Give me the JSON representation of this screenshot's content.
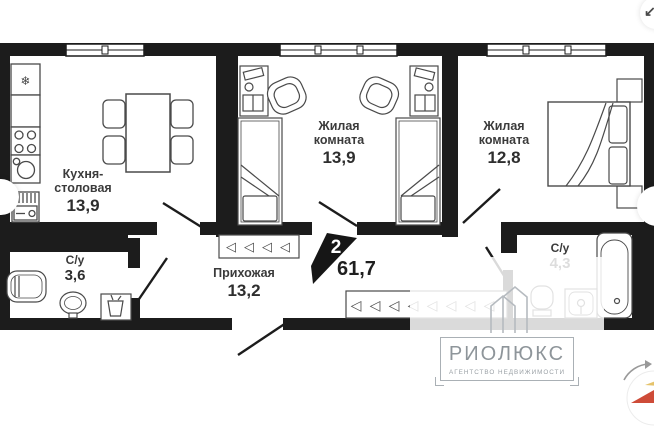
{
  "plan": {
    "badge": {
      "rooms": "2",
      "total_area": "61,7"
    },
    "rooms": [
      {
        "id": "kitchen",
        "name": "Кухня-столовая",
        "area": "13,9"
      },
      {
        "id": "living-1",
        "name": "Жилая комната",
        "area": "13,9"
      },
      {
        "id": "living-2",
        "name": "Жилая комната",
        "area": "12,8"
      },
      {
        "id": "bath-small",
        "name": "С/у",
        "area": "3,6"
      },
      {
        "id": "hallway",
        "name": "Прихожая",
        "area": "13,2"
      },
      {
        "id": "bath-big",
        "name": "С/у",
        "area": "4,3"
      }
    ]
  },
  "watermark": {
    "brand": "РИОЛЮКС",
    "tagline": "АГЕНТСТВО НЕДВИЖИМОСТИ"
  },
  "glyphs": {
    "hanger": "◁",
    "snowflake": "❄",
    "collapse_arrow": "↙"
  },
  "colors": {
    "wall": "#1c1c1c",
    "furniture_outline": "#4a4a4a",
    "label_text": "#3b3b3b",
    "watermark_gray": "#9aa0a5",
    "compass_needle_red": "#ce4b38",
    "compass_needle_gold": "#e5c36b"
  }
}
